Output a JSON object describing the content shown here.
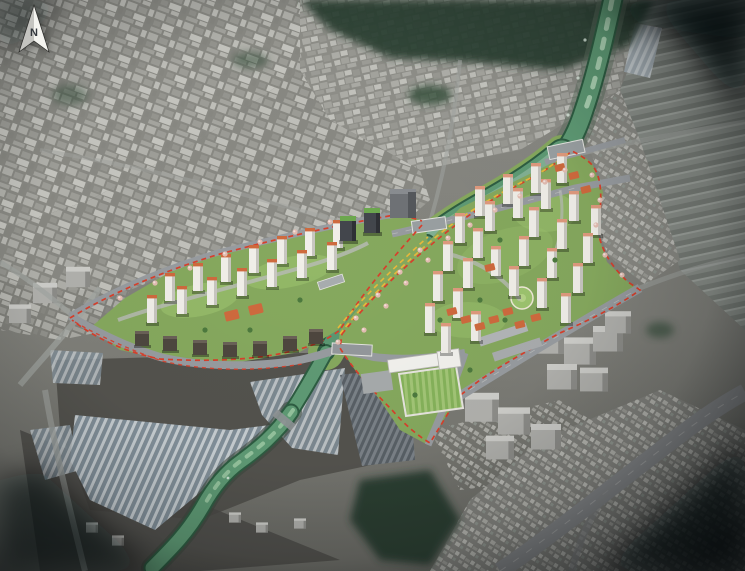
{
  "compass": {
    "label": "N",
    "icon": "north-arrow-icon"
  },
  "palette": {
    "ground_gray": "#7e7e78",
    "city_gray": "#8c8c86",
    "city_block_light": "#bdbdb7",
    "vegetation_dark": "#2c4130",
    "river_green": "#5f9b75",
    "river_deep": "#2e5d42",
    "river_highlight": "#cdeccf",
    "river_wide_tint": "#9fc2ad",
    "site_green": "#86a95e",
    "site_lawn": "#9ec46f",
    "road_gray": "#989ca0",
    "boundary_red": "#d8402c",
    "boundary_yellow": "#e8b93c",
    "tower_white": "#f1efe9",
    "tower_shade": "#c8c6c0",
    "roof_orange": "#cf6a3e",
    "roof_salmon": "#df9a7e",
    "office_dark": "#43464c",
    "office_roof_green": "#6da84e",
    "blossom_pink": "#e3bdb2",
    "greenhouse_light": "#c7ced2",
    "greenhouse_dark": "#82909a",
    "soil_dark": "#54534e",
    "vignette": "#05080a"
  }
}
